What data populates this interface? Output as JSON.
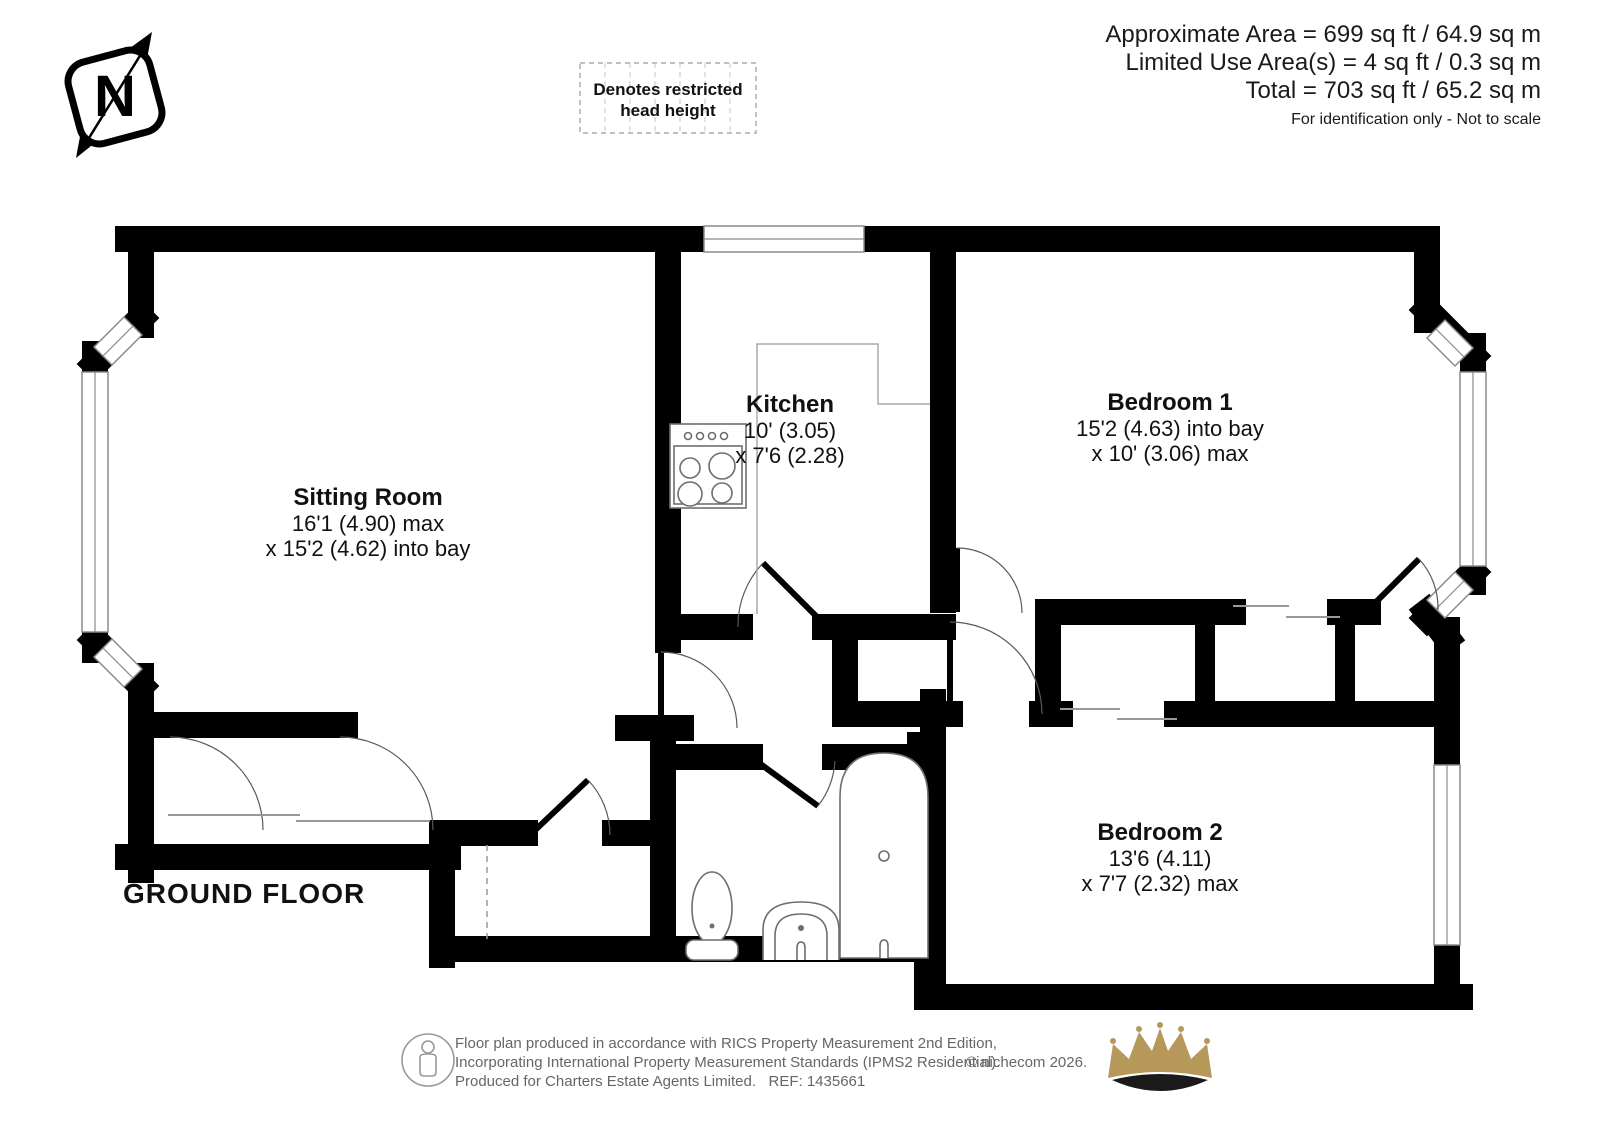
{
  "compass": {
    "letter": "N"
  },
  "legend": {
    "line1": "Denotes restricted",
    "line2": "head height"
  },
  "area_summary": {
    "line1": "Approximate Area = 699 sq ft / 64.9 sq m",
    "line2": "Limited Use Area(s) = 4 sq ft / 0.3 sq m",
    "line3": "Total = 703 sq ft / 65.2 sq m",
    "note": "For identification only - Not to scale"
  },
  "floor_label": "GROUND FLOOR",
  "rooms": {
    "sitting_room": {
      "name": "Sitting Room",
      "dim1": "16'1 (4.90) max",
      "dim2": "x 15'2 (4.62) into bay"
    },
    "kitchen": {
      "name": "Kitchen",
      "dim1": "10' (3.05)",
      "dim2": "x 7'6 (2.28)"
    },
    "bedroom1": {
      "name": "Bedroom 1",
      "dim1": "15'2 (4.63) into bay",
      "dim2": "x 10' (3.06) max"
    },
    "bedroom2": {
      "name": "Bedroom 2",
      "dim1": "13'6 (4.11)",
      "dim2": "x 7'7 (2.32) max"
    }
  },
  "footer": {
    "line1": "Floor plan produced in accordance with RICS Property Measurement 2nd Edition,",
    "line2": "Incorporating International Property Measurement Standards (IPMS2 Residential).",
    "line3": "Produced for Charters Estate Agents Limited.   REF: 1435661",
    "copyright": "© nichecom 2026."
  },
  "colors": {
    "wall": "#000000",
    "crown_gold": "#b5985a",
    "text_muted": "#666666"
  }
}
